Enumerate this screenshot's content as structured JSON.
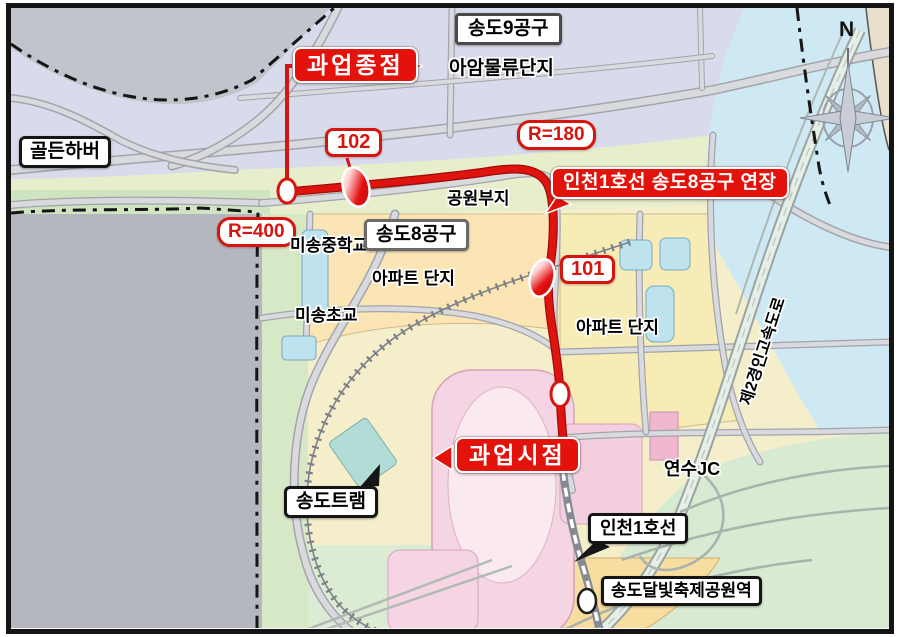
{
  "map": {
    "compass_north": "N",
    "callouts": {
      "project_end": "과업종점",
      "project_start": "과업시점",
      "extension_line": "인천1호선 송도8공구 연장"
    },
    "station_badges": {
      "s102": "102",
      "s101": "101"
    },
    "curve_badges": {
      "r180": "R=180",
      "r400": "R=400"
    },
    "boxed_places": {
      "district9": "송도9공구",
      "district8": "송도8공구",
      "golden_harbor": "골든하버",
      "songdo_tram": "송도트램",
      "incheon_line1": "인천1호선",
      "moonlight_station": "송도달빛축제공원역"
    },
    "plain_places": {
      "aam_logistics": "아암물류단지",
      "park_site": "공원부지",
      "misong_middle_school": "미송중학교",
      "misong_elementary_school": "미송초교",
      "apartment_complex_left": "아파트 단지",
      "apartment_complex_right": "아파트 단지",
      "yeonsu_jc": "연수JC",
      "expressway": "제2경인고속도로"
    },
    "colors": {
      "route_red": "#e0140e",
      "callout_red": "#e3120b",
      "water_blue": "#cfe9f4",
      "parcel_cream": "#f5eecb",
      "parcel_pink": "#f5d4e3",
      "out_of_scope_gray": "#b5b7be"
    }
  }
}
